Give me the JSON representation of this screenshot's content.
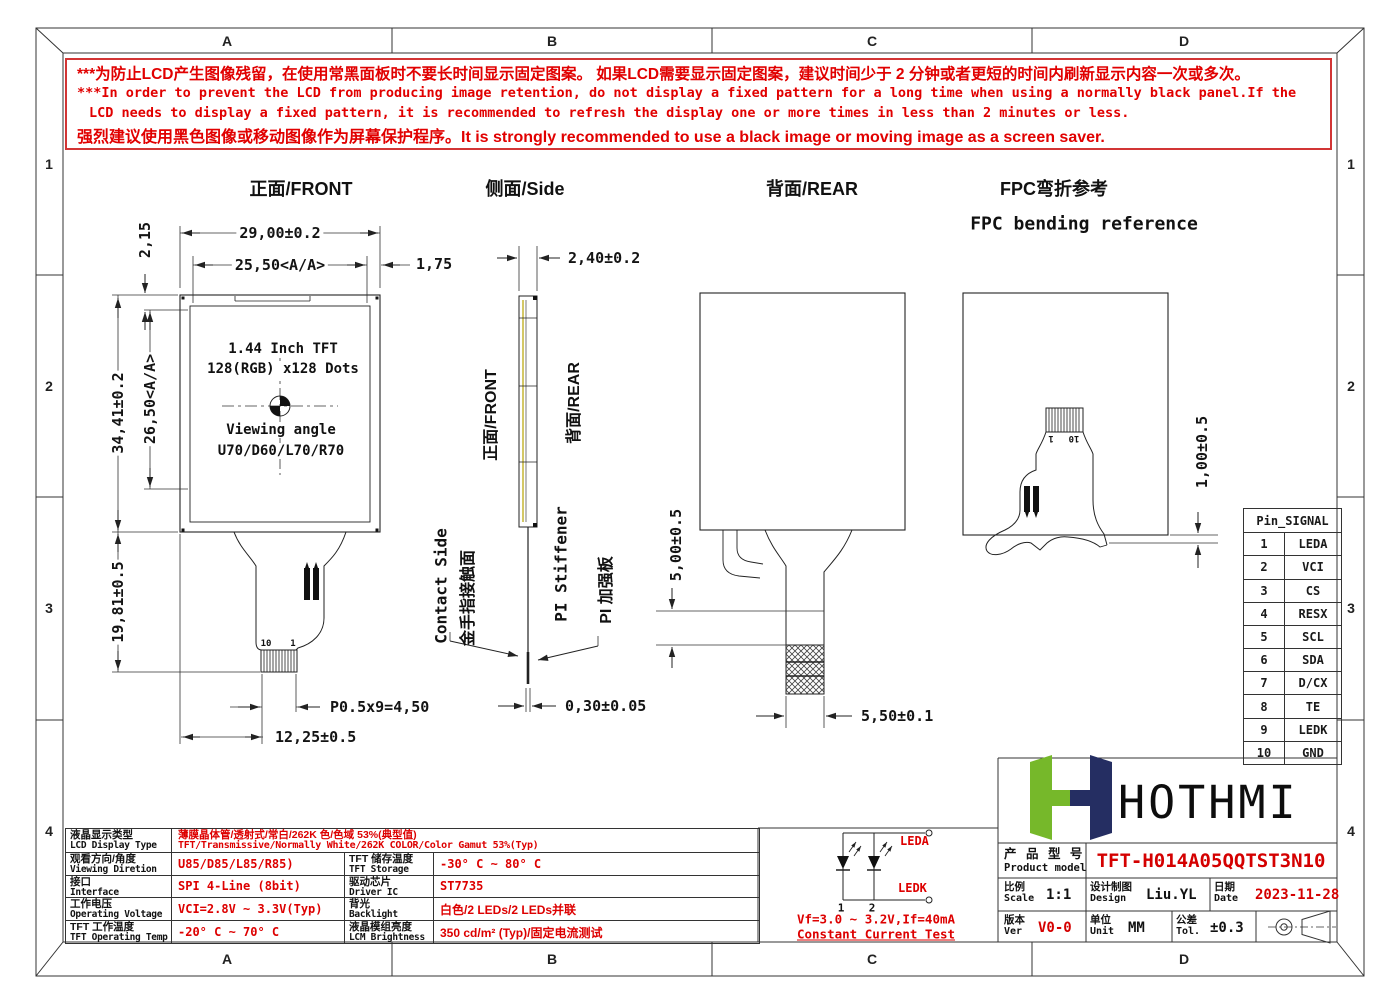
{
  "frame": {
    "zones_h": [
      "A",
      "B",
      "C",
      "D"
    ],
    "zones_v": [
      "1",
      "2",
      "3",
      "4"
    ]
  },
  "warning": {
    "line1": "***为防止LCD产生图像残留，在使用常黑面板时不要长时间显示固定图案。 如果LCD需要显示固定图案，建议时间少于 2 分钟或者更短的时间内刷新显示内容一次或多次。",
    "line2": "***In order to prevent the LCD from producing image retention, do not display a fixed pattern for a long time when using a normally black panel.If the",
    "line3": "LCD needs to display a fixed pattern, it is recommended to refresh the display one or more times in less than 2 minutes or less.",
    "line4": "强烈建议使用黑色图像或移动图像作为屏幕保护程序。It is strongly recommended to use a black image or moving image as a screen saver."
  },
  "views": {
    "front": {
      "title": "正面/FRONT",
      "dim_width": "29,00±0.2",
      "dim_aa_width": "25,50<A/A>",
      "dim_right_margin": "1,75",
      "dim_top_margin": "2,15",
      "dim_height": "34,41±0.2",
      "dim_aa_height": "26,50<A/A>",
      "dim_tail_length": "19,81±0.5",
      "dim_pitch": "P0.5x9=4,50",
      "dim_tail_width": "12,25±0.5",
      "pin_left": "10",
      "pin_right": "1",
      "display_line1": "1.44 Inch TFT",
      "display_line2": "128(RGB) x128 Dots",
      "display_line3": "Viewing angle",
      "display_line4": "U70/D60/L70/R70"
    },
    "side": {
      "title": "侧面/Side",
      "dim_thickness": "2,40±0.2",
      "dim_fpc_thickness": "0,30±0.05",
      "label_front": "正面/FRONT",
      "label_rear": "背面/REAR",
      "label_contact_en": "Contact Side",
      "label_contact_cn": "金手指接触面",
      "label_stiffener_en": "PI Stiffener",
      "label_stiffener_cn": "PI 加强板"
    },
    "rear": {
      "title": "背面/REAR",
      "dim_stiffener": "5,00±0.5",
      "dim_tail_width": "5,50±0.1"
    },
    "bend": {
      "title_cn": "FPC弯折参考",
      "title_en": "FPC bending reference",
      "dim_protrusion": "1,00±0.5",
      "pin_left": "1",
      "pin_right": "10"
    }
  },
  "pin_table": {
    "header": "Pin_SIGNAL",
    "rows": [
      {
        "pin": "1",
        "signal": "LEDA"
      },
      {
        "pin": "2",
        "signal": "VCI"
      },
      {
        "pin": "3",
        "signal": "CS"
      },
      {
        "pin": "4",
        "signal": "RESX"
      },
      {
        "pin": "5",
        "signal": "SCL"
      },
      {
        "pin": "6",
        "signal": "SDA"
      },
      {
        "pin": "7",
        "signal": "D/CX"
      },
      {
        "pin": "8",
        "signal": "TE"
      },
      {
        "pin": "9",
        "signal": "LEDK"
      },
      {
        "pin": "10",
        "signal": "GND"
      }
    ]
  },
  "led_circuit": {
    "anode_label": "LEDA",
    "cathode_label": "LEDK",
    "pin1": "1",
    "pin2": "2",
    "spec": "Vf=3.0 ~ 3.2V,If=40mA",
    "test": "Constant Current Test"
  },
  "spec_table": {
    "rows": [
      {
        "label_cn": "液晶显示类型",
        "label_en": "LCD Display Type",
        "value_cn": "薄膜晶体管/透射式/常白/262K 色/色域 53%(典型值)",
        "value_en": "TFT/Transmissive/Normally White/262K COLOR/Color Gamut 53%(Typ)"
      },
      {
        "label_cn": "观看方向/角度",
        "label_en": "Viewing Diretion",
        "value": "U85/D85/L85/R85)",
        "label2_cn": "TFT 储存温度",
        "label2_en": "TFT Storage Temp",
        "value2": "-30° C ~ 80° C"
      },
      {
        "label_cn": "接口",
        "label_en": "Interface",
        "value": "SPI 4-Line (8bit)",
        "label2_cn": "驱动芯片",
        "label2_en": "Driver IC",
        "value2": "ST7735"
      },
      {
        "label_cn": "工作电压",
        "label_en": "Operating Voltage",
        "value": "VCI=2.8V ~ 3.3V(Typ)",
        "label2_cn": "背光",
        "label2_en": "Backlight",
        "value2": "白色/2 LEDs/2 LEDs并联"
      },
      {
        "label_cn": "TFT 工作温度",
        "label_en": "TFT Operating Temp",
        "value": "-20° C ~ 70° C",
        "label2_cn": "液晶模组亮度",
        "label2_en": "LCM Brightness",
        "value2": "350 cd/m² (Typ)/固定电流测试"
      }
    ]
  },
  "title_block": {
    "brand": "HOTHMI",
    "product_label_cn": "产 品 型 号",
    "product_label_en": "Product model",
    "product_model": "TFT-H014A05QQTST3N10",
    "scale_cn": "比例",
    "scale_en": "Scale",
    "scale": "1:1",
    "design_cn": "设计制图",
    "design_en": "Design",
    "designer": "Liu.YL",
    "date_cn": "日期",
    "date_en": "Date",
    "date": "2023-11-28",
    "ver_cn": "版本",
    "ver_en": "Ver",
    "version": "V0-0",
    "unit_cn": "单位",
    "unit_en": "Unit",
    "unit": "MM",
    "tol_cn": "公差",
    "tol_en": "Tol.",
    "tolerance": "±0.3"
  },
  "colors": {
    "accent_red": "#dd0000",
    "logo_green": "#76b82a",
    "logo_navy": "#252e62",
    "line": "#2b2b2b"
  }
}
